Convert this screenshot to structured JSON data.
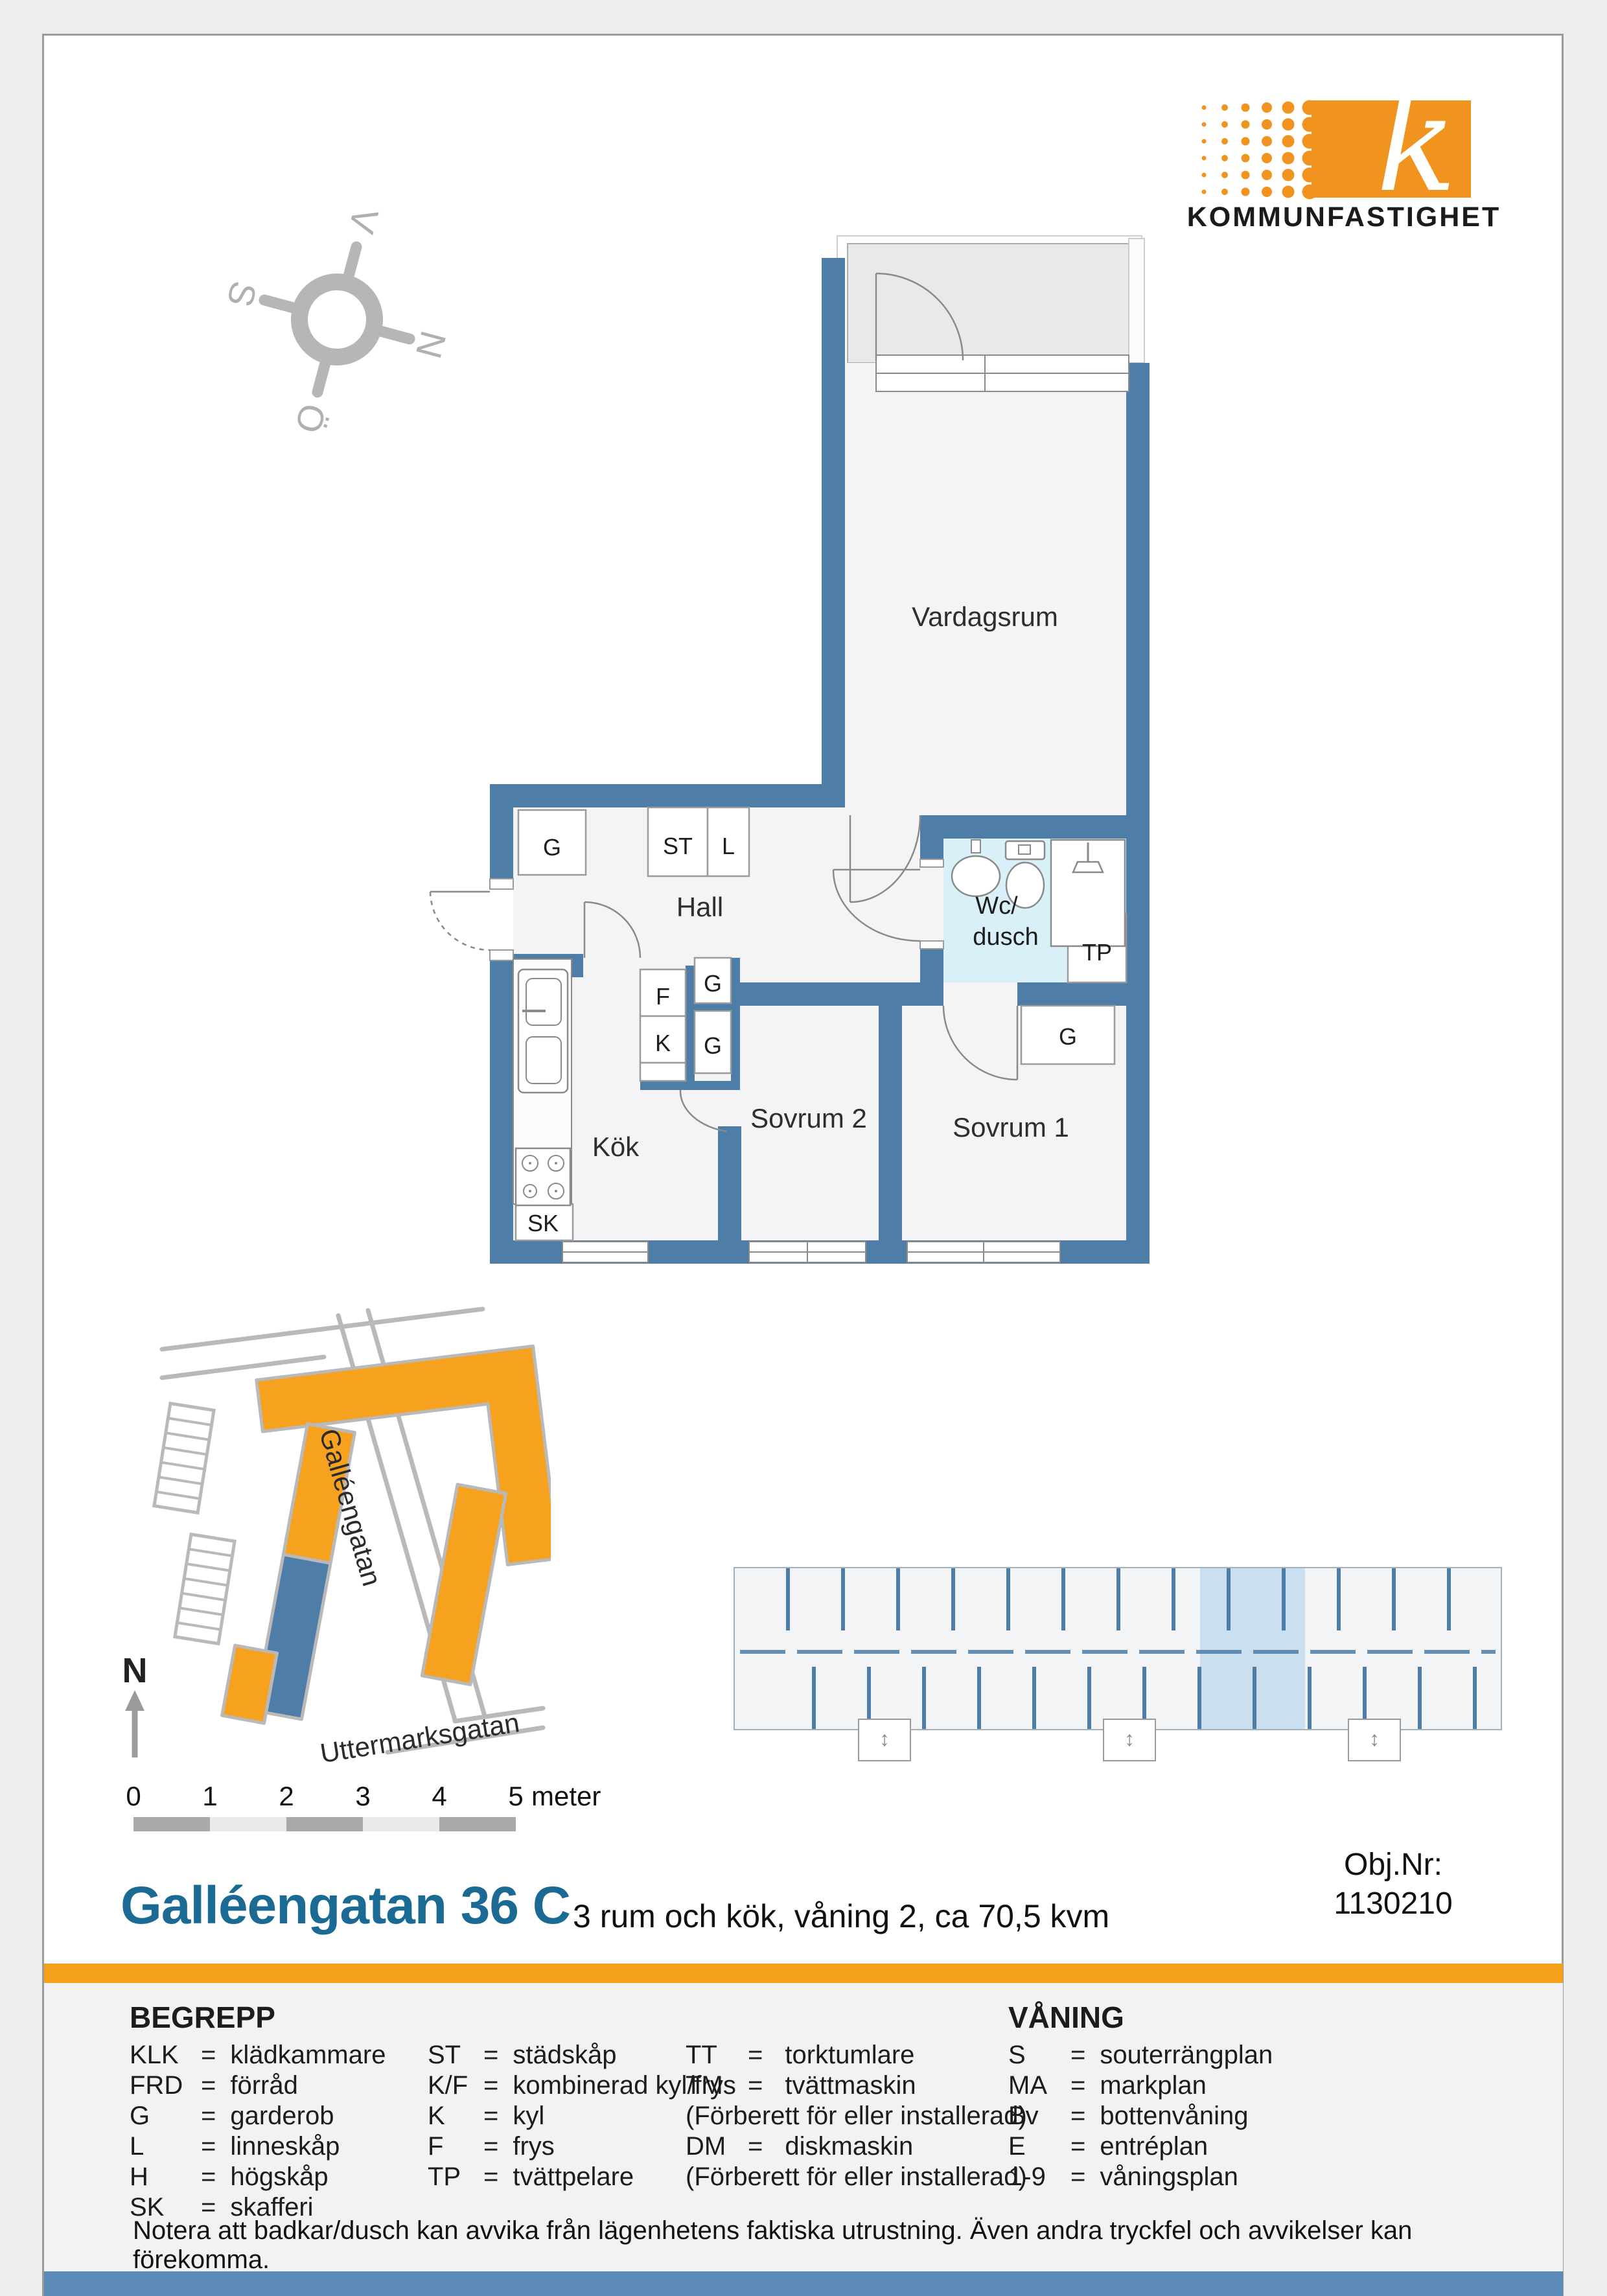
{
  "logo": {
    "text": "KOMMUNFASTIGHET",
    "letter": "k"
  },
  "compass": {
    "n": "N",
    "v": "V",
    "s": "S",
    "o": "Ö"
  },
  "floorplan": {
    "rooms": {
      "vardagsrum": "Vardagsrum",
      "hall": "Hall",
      "wc1": "Wc/",
      "wc2": "dusch",
      "kok": "Kök",
      "sovrum2": "Sovrum 2",
      "sovrum1": "Sovrum 1"
    },
    "closets": {
      "g_hall": "G",
      "st": "ST",
      "l": "L",
      "f": "F",
      "k": "K",
      "g1": "G",
      "g2": "G",
      "g_sov": "G",
      "sk": "SK",
      "tp": "TP"
    }
  },
  "sitemap": {
    "street_main": "Galléengatan",
    "street_cross": "Uttermarksgatan",
    "north": "N"
  },
  "scalebar": {
    "ticks": [
      "0",
      "1",
      "2",
      "3",
      "4",
      "5"
    ],
    "unit": "meter"
  },
  "titleblock": {
    "title": "Galléengatan 36 C",
    "subtitle": "3 rum och kök, våning 2, ca 70,5 kvm",
    "obj_label": "Obj.Nr:",
    "obj_value": "1130210"
  },
  "legend": {
    "title": "BEGREPP",
    "eq": "=",
    "col1": [
      {
        "a": "KLK",
        "t": "klädkammare"
      },
      {
        "a": "FRD",
        "t": "förråd"
      },
      {
        "a": "G",
        "t": "garderob"
      },
      {
        "a": "L",
        "t": "linneskåp"
      },
      {
        "a": "H",
        "t": "högskåp"
      },
      {
        "a": "SK",
        "t": "skafferi"
      }
    ],
    "col2": [
      {
        "a": "ST",
        "t": "städskåp"
      },
      {
        "a": "K/F",
        "t": "kombinerad kyl/frys"
      },
      {
        "a": "K",
        "t": "kyl"
      },
      {
        "a": "F",
        "t": "frys"
      },
      {
        "a": "TP",
        "t": "tvättpelare"
      }
    ],
    "col3": [
      {
        "a": "TT",
        "t": "torktumlare"
      },
      {
        "a": "TM",
        "t": "tvättmaskin"
      },
      {
        "p": "(Förberett för eller installerad)"
      },
      {
        "a": "DM",
        "t": "diskmaskin"
      },
      {
        "p": "(Förberett för eller installerad)"
      }
    ],
    "vaning": {
      "title": "VÅNING",
      "rows": [
        {
          "a": "S",
          "t": "souterrängplan"
        },
        {
          "a": "MA",
          "t": "markplan"
        },
        {
          "a": "Bv",
          "t": "bottenvåning"
        },
        {
          "a": "E",
          "t": "entréplan"
        },
        {
          "a": "1-9",
          "t": "våningsplan"
        }
      ]
    }
  },
  "note": "Notera att badkar/dusch kan avvika från lägenhetens faktiska utrustning. Även andra tryckfel och avvikelser kan förekomma.",
  "colors": {
    "wall_blue": "#4e7da7",
    "orange": "#f5a11c",
    "logo_orange": "#f0941f",
    "title_blue": "#1a6a94",
    "wc_floor": "#d9f0f8",
    "highlight_blue": "#cadff0",
    "bottom_bar": "#5d8bb7"
  }
}
